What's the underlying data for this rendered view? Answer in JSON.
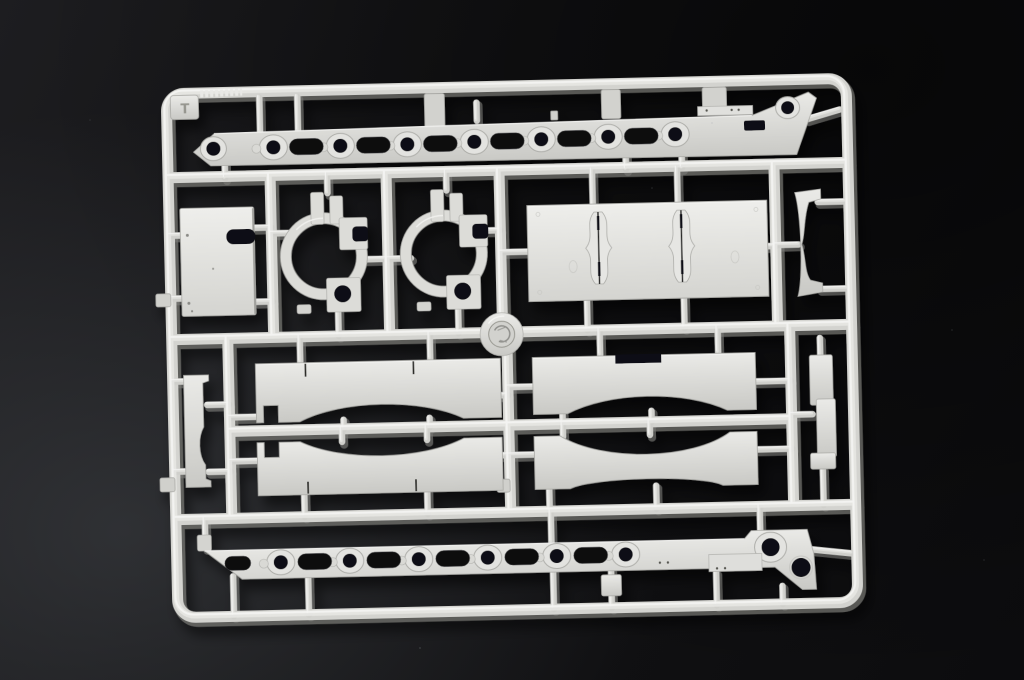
{
  "scene": {
    "description": "Light gray injection-molded plastic model kit sprue with armored-vehicle hull parts, photographed on a dark charcoal surface",
    "sprue_letter": "T",
    "colors": {
      "plastic_base": "#d3d3cf",
      "plastic_highlight": "#f6f6f4",
      "plastic_shadow": "#84847f",
      "hole_dark": "#0f0f12",
      "background": "#121214"
    }
  },
  "parts_manifest": [
    {
      "name": "hull-side-panel-upper",
      "count": 1
    },
    {
      "name": "hull-side-panel-lower",
      "count": 1
    },
    {
      "name": "flat-access-panel",
      "count": 1
    },
    {
      "name": "round-housing-bracket",
      "count": 2
    },
    {
      "name": "large-plate-with-torsion-channels",
      "count": 1
    },
    {
      "name": "curved-support-strip",
      "count": 1
    },
    {
      "name": "stepped-side-rail",
      "count": 1
    },
    {
      "name": "suspension-fender-bracket",
      "count": 4
    },
    {
      "name": "narrow-side-strip",
      "count": 1
    },
    {
      "name": "small-block",
      "count": 1
    },
    {
      "name": "injection-gate-disc",
      "count": 1
    }
  ]
}
